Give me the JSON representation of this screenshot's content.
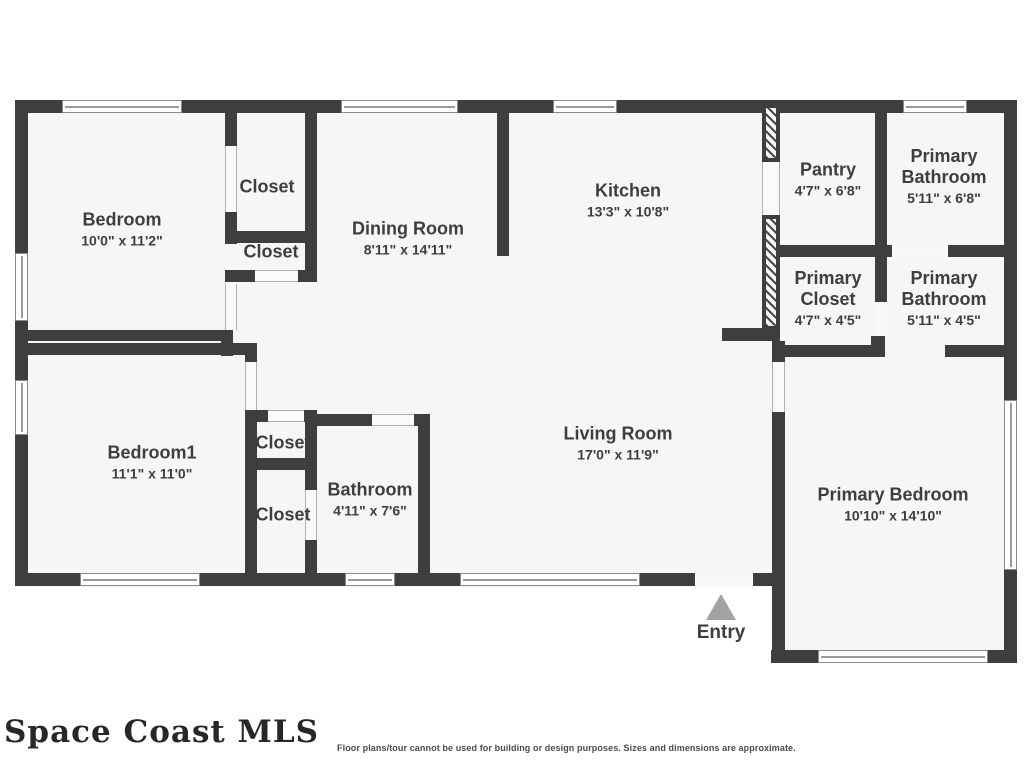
{
  "watermark": "Space Coast MLS",
  "disclaimer": "Floor plans/tour cannot be used for building or design purposes. Sizes and dimensions are approximate.",
  "colors": {
    "wall": "#3e3e3e",
    "interior": "#f6f6f5",
    "entry_arrow": "#a3a3a3",
    "text": "#3e3e3e"
  },
  "rooms": {
    "bedroom": {
      "name": "Bedroom",
      "dims": "10'0\" x 11'2\""
    },
    "closet_a": {
      "name": "Closet"
    },
    "closet_b": {
      "name": "Closet"
    },
    "dining_room": {
      "name": "Dining Room",
      "dims": "8'11\" x 14'11\""
    },
    "kitchen": {
      "name": "Kitchen",
      "dims": "13'3\" x 10'8\""
    },
    "pantry": {
      "name": "Pantry",
      "dims": "4'7\" x 6'8\""
    },
    "primary_bathroom_upper": {
      "name": "Primary Bathroom",
      "dims": "5'11\" x 6'8\""
    },
    "primary_closet": {
      "name": "Primary Closet",
      "dims": "4'7\" x 4'5\""
    },
    "primary_bathroom_lower": {
      "name": "Primary Bathroom",
      "dims": "5'11\" x 4'5\""
    },
    "bedroom1": {
      "name": "Bedroom1",
      "dims": "11'1\" x 11'0\""
    },
    "closet_c": {
      "name": "Closet"
    },
    "closet_d": {
      "name": "Closet"
    },
    "bathroom": {
      "name": "Bathroom",
      "dims": "4'11\" x 7'6\""
    },
    "living_room": {
      "name": "Living Room",
      "dims": "17'0\" x 11'9\""
    },
    "primary_bedroom": {
      "name": "Primary Bedroom",
      "dims": "10'10\" x 14'10\""
    },
    "entry": {
      "name": "Entry"
    }
  }
}
